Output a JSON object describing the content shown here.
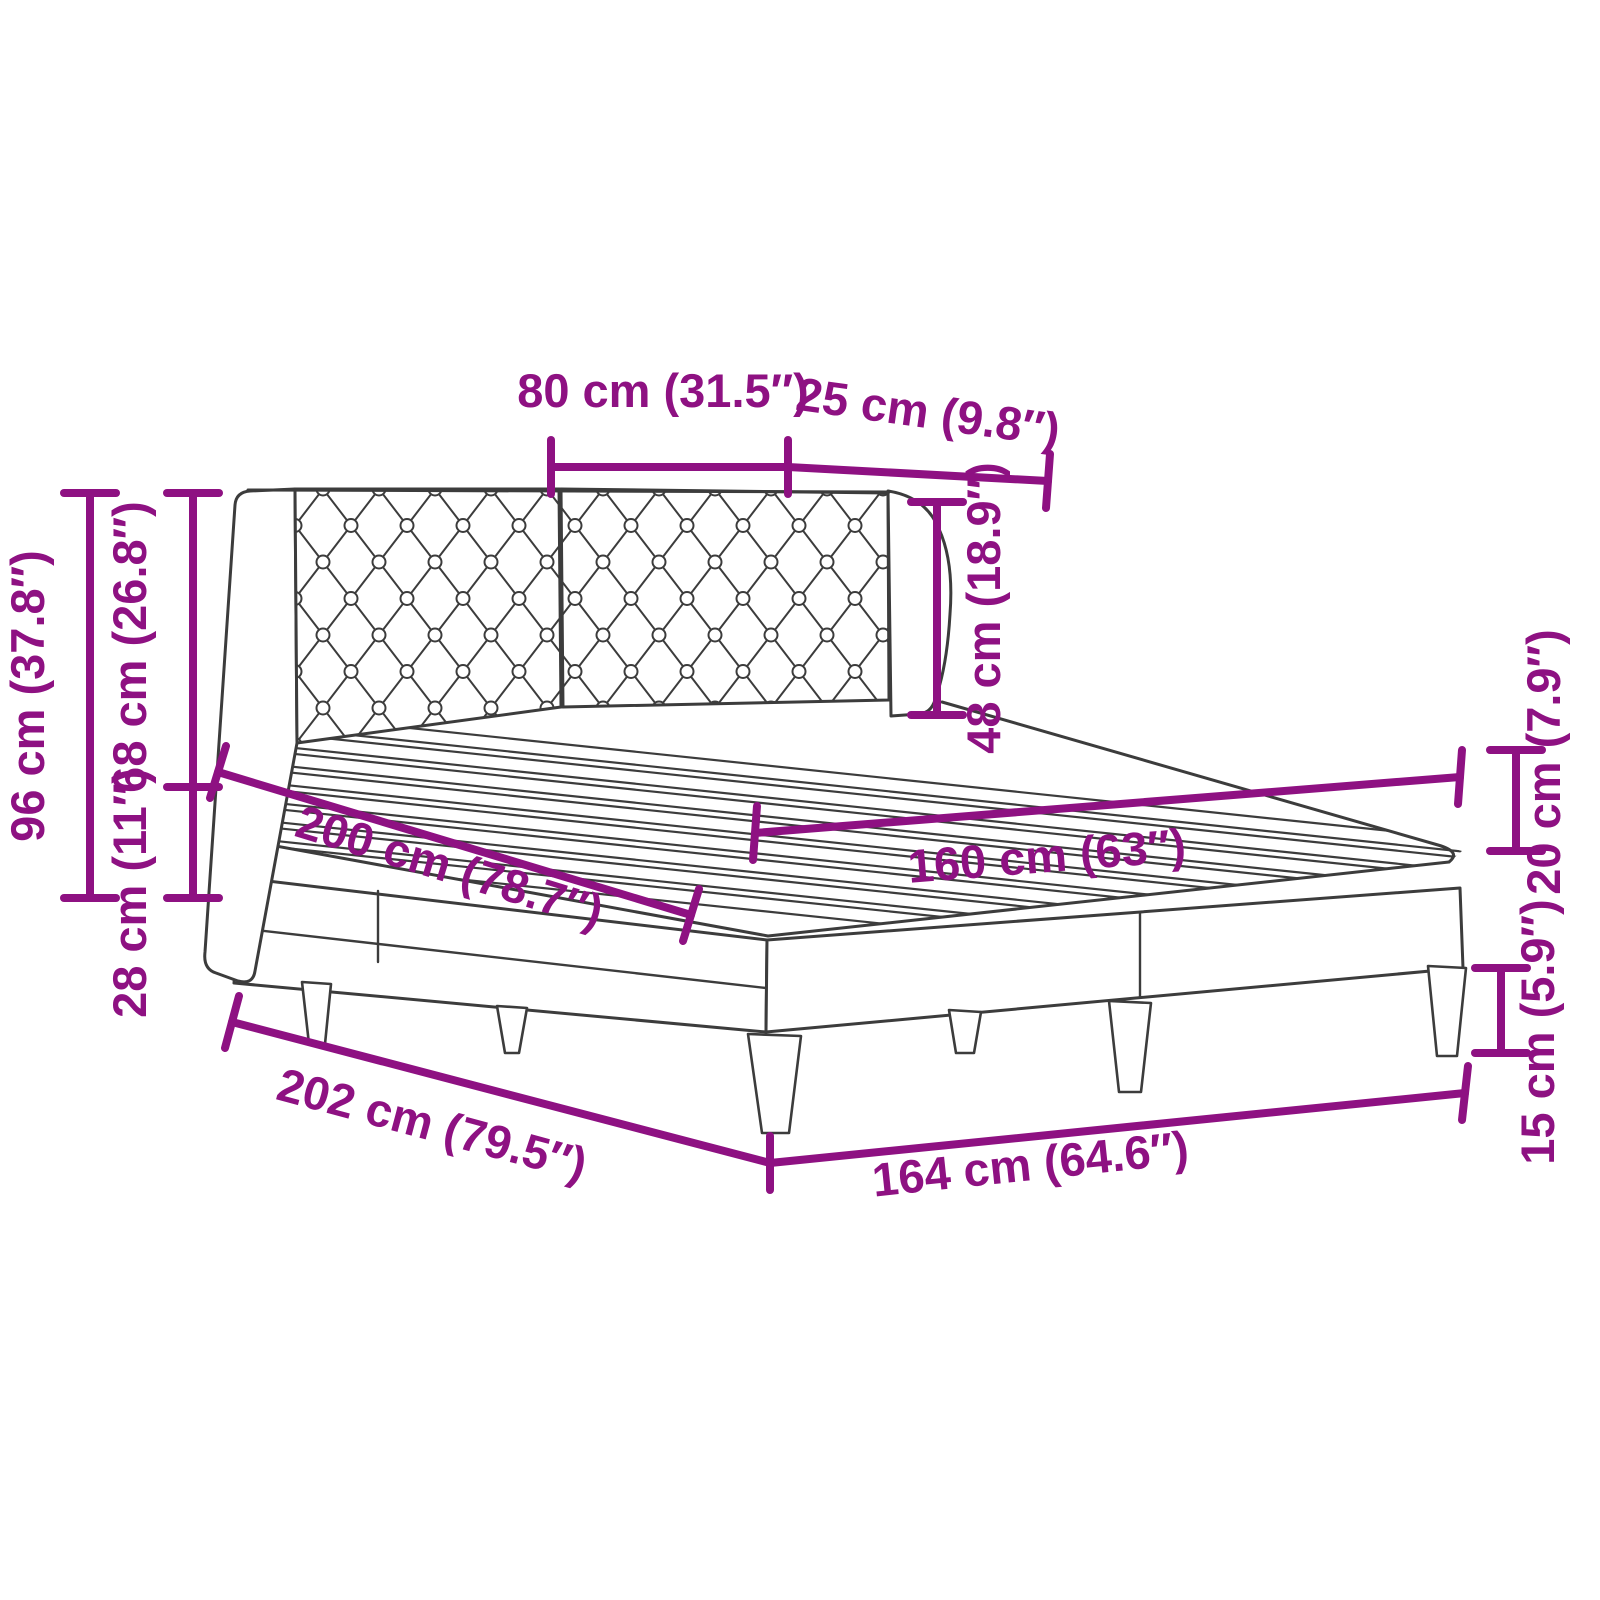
{
  "diagram": {
    "type": "product-dimension-diagram",
    "subject": "upholstered bed frame with tufted headboard, slatted base and tapered legs",
    "colors": {
      "dimension_color": "#8E1182",
      "line_art_color": "#3C3C3C",
      "background": "#FFFFFF"
    },
    "dimensions": {
      "headboard_panel_width": {
        "cm": 80,
        "in": 31.5,
        "label": "80 cm (31.5″)"
      },
      "headboard_wing_width": {
        "cm": 25,
        "in": 9.8,
        "label": "25 cm (9.8″)"
      },
      "headboard_above_slats": {
        "cm": 48,
        "in": 18.9,
        "label": "48 cm (18.9″)"
      },
      "total_height": {
        "cm": 96,
        "in": 37.8,
        "label": "96 cm (37.8″)"
      },
      "headboard_height": {
        "cm": 68,
        "in": 26.8,
        "label": "68 cm (26.8″)"
      },
      "base_section_height": {
        "cm": 28,
        "in": 11,
        "label": "28 cm (11″)"
      },
      "sleeping_length": {
        "cm": 200,
        "in": 78.7,
        "label": "200 cm (78.7″)"
      },
      "sleeping_width": {
        "cm": 160,
        "in": 63,
        "label": "160 cm (63″)"
      },
      "box_height": {
        "cm": 20,
        "in": 7.9,
        "label": "20 cm (7.9″)"
      },
      "leg_height": {
        "cm": 15,
        "in": 5.9,
        "label": "15 cm (5.9″)"
      },
      "frame_length": {
        "cm": 202,
        "in": 79.5,
        "label": "202 cm (79.5″)"
      },
      "frame_width": {
        "cm": 164,
        "in": 64.6,
        "label": "164 cm (64.6″)"
      }
    }
  }
}
